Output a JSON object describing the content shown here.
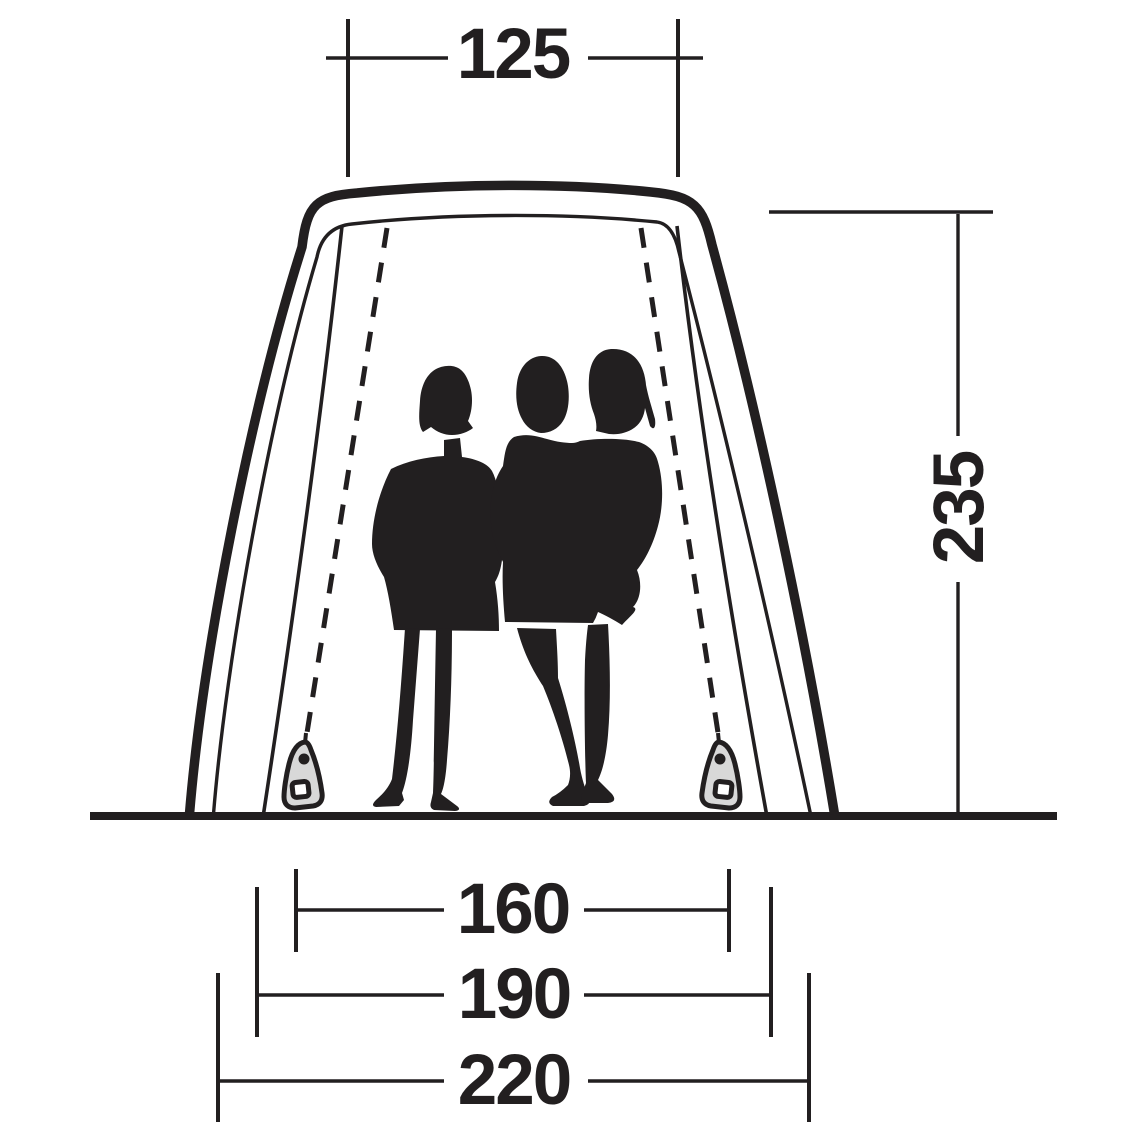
{
  "diagram": {
    "dimensions": {
      "top_width": "125",
      "height": "235",
      "inner_floor_width": "160",
      "mid_width": "190",
      "outer_base_width": "220"
    },
    "colors": {
      "ink": "#221f20",
      "zipper_fill": "#d8d8d8",
      "background": "#ffffff"
    },
    "icons": {
      "left_pull": "zipper-pull-icon",
      "right_pull": "zipper-pull-icon"
    }
  }
}
